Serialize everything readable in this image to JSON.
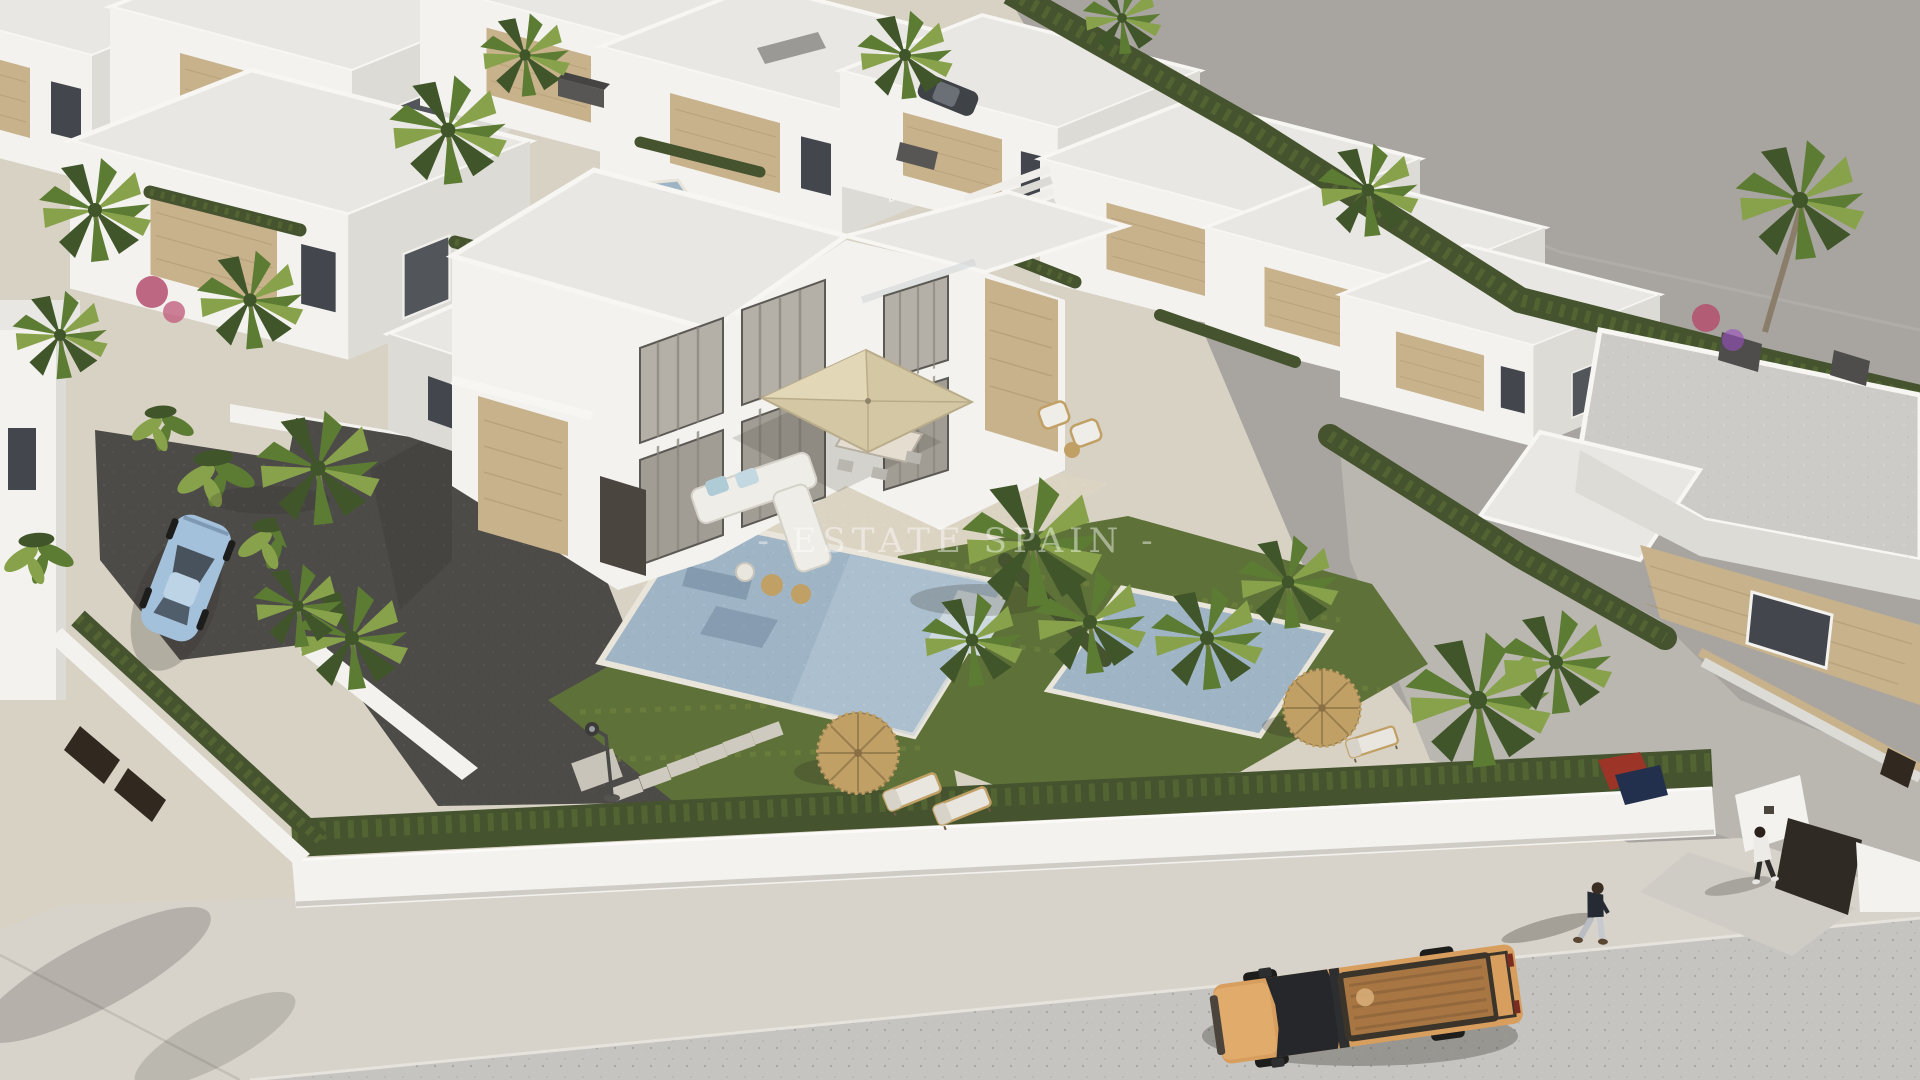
{
  "watermark": {
    "text": "- ESTATE SPAIN -",
    "color": "#ffffff"
  },
  "palette": {
    "sand": "#d8d2c5",
    "ground": "#a8a5a0",
    "groundLine": "#b6b3ae",
    "concrete": "#bab7b1",
    "road": "#c6c4c1",
    "sidewalk": "#d7d3cb",
    "wallWhite": "#f3f2ee",
    "wallShade": "#dddbd6",
    "roofLight": "#e8e7e3",
    "roofMid": "#cccbc7",
    "roofDark": "#9b9996",
    "stone": "#c8b28c",
    "stoneDark": "#a7916b",
    "glass": "#43474d",
    "curtain": "#b5b0a7",
    "curtainDark": "#8a867e",
    "hedge": "#45532e",
    "hedgeLight": "#5f7239",
    "lawn": "#5e7138",
    "lawnLight": "#74883f",
    "palmDark": "#40562a",
    "palmMid": "#5d7c33",
    "palmLight": "#87a24b",
    "trunk": "#8a7d6a",
    "pool": "#9fb5c6",
    "poolLight": "#bccdd8",
    "poolStep": "#cdd9df",
    "gravel": "#4d4b48",
    "terrace": "#dcd4c3",
    "umbrella": "#d4c7a3",
    "umbrellaLight": "#e2d7b6",
    "wicker": "#c1a066",
    "wickerDark": "#997e4e",
    "redUmbrella": "#b2593a",
    "truckBody": "#d79e5e",
    "truckHood": "#e0ab6b",
    "truckBed": "#a87643",
    "truckGlass": "#25272a",
    "tire": "#1d1d1c",
    "carBlue": "#a4c1dc",
    "carRoof": "#bdd3e6",
    "carGlass": "#47525d",
    "gate": "#31291f",
    "shadow": "#2e2a25",
    "bougainvillea": "#b44f6e",
    "lamp": "#4a4a48"
  },
  "scene": {
    "type": "aerial 3D architectural render of a residential villa development",
    "objects": [
      "modern white villas",
      "private pool",
      "second pool",
      "palm trees",
      "hedges",
      "perimeter wall with gates",
      "gravel driveway",
      "terrace with square parasol",
      "outdoor corner sofa",
      "dining set",
      "straw parasols",
      "sun loungers",
      "orange pickup truck",
      "light blue parked car",
      "two pedestrians",
      "street lamp",
      "stepping stones",
      "red pool umbrella",
      "exterior staircase"
    ]
  }
}
